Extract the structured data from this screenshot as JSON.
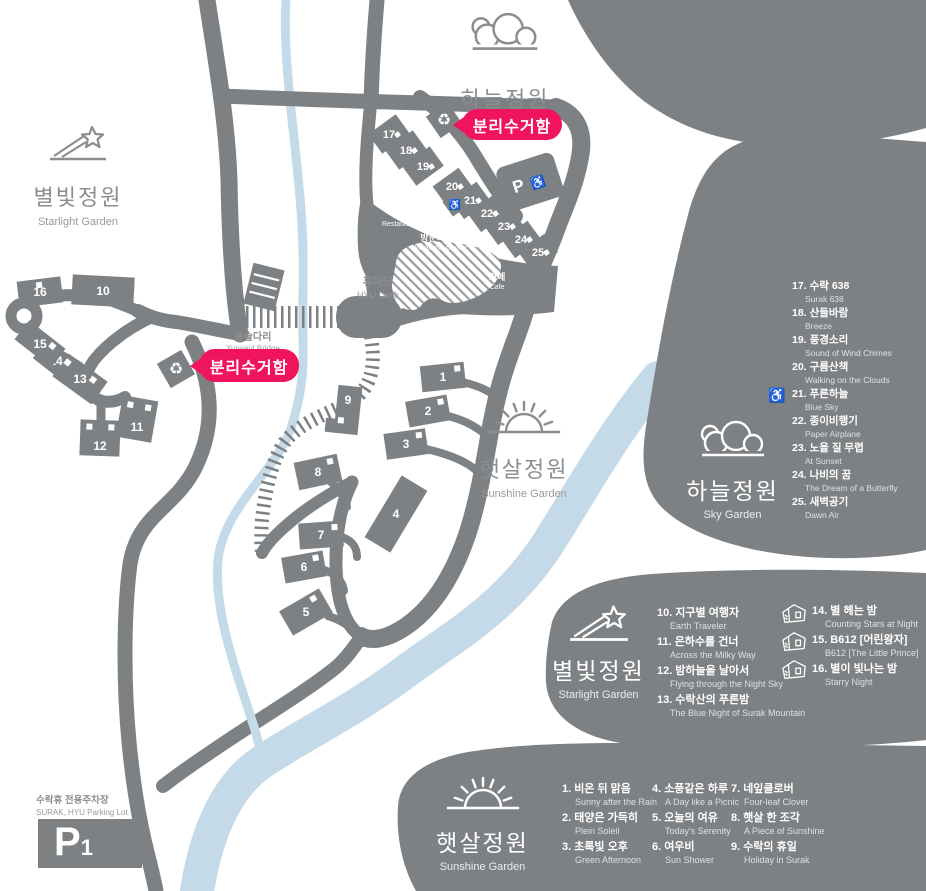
{
  "colors": {
    "gray": "#7e8184",
    "river": "#c5dae8",
    "accent_pink": "#f0145c"
  },
  "icons": {
    "wheelchair": "♿",
    "recycle": "♻"
  },
  "badges": {
    "recycling": "분리수거함"
  },
  "map": {
    "gardens": {
      "sky": {
        "ko": "하늘정원"
      },
      "starlight": {
        "ko": "별빛정원",
        "en": "Starlight Garden"
      },
      "sunshine": {
        "ko": "햇살정원",
        "en": "Sunshine Garden"
      }
    },
    "facilities": {
      "restaurant": {
        "ko": "식당",
        "en": "Restaurant"
      },
      "welcome_center": {
        "ko": "방문자센터",
        "en": "Welcome Center"
      },
      "hyu_deck": {
        "ko": "휴마당",
        "en": "HYU Deck"
      },
      "cafe": {
        "ko": "카페",
        "en": "Cafe"
      },
      "bridge": {
        "ko": "윤슬다리",
        "en": "Yunseul Bridge"
      },
      "parking": {
        "ko": "수락휴 전용주차장",
        "en": "SURAK, HYU Parking Lot",
        "code": "P1"
      },
      "accessible_parking": {
        "label": "P"
      }
    },
    "site_numbers": [
      "1",
      "2",
      "3",
      "4",
      "5",
      "6",
      "7",
      "8",
      "9",
      "10",
      "11",
      "12",
      "13",
      "14",
      "15",
      "16",
      "17",
      "18",
      "19",
      "20",
      "21",
      "22",
      "23",
      "24",
      "25"
    ]
  },
  "legends": {
    "sky": {
      "title_ko": "하늘정원",
      "title_en": "Sky Garden",
      "items": [
        {
          "num": "17.",
          "ko": "수락 638",
          "en": "Surak 638"
        },
        {
          "num": "18.",
          "ko": "산들바람",
          "en": "Breeze"
        },
        {
          "num": "19.",
          "ko": "풍경소리",
          "en": "Sound of Wind Chimes"
        },
        {
          "num": "20.",
          "ko": "구름산책",
          "en": "Walking on the Clouds"
        },
        {
          "num": "21.",
          "ko": "푸른하늘",
          "en": "Blue Sky"
        },
        {
          "num": "22.",
          "ko": "종이비행기",
          "en": "Paper Airplane"
        },
        {
          "num": "23.",
          "ko": "노을 질 무렵",
          "en": "At Sunset"
        },
        {
          "num": "24.",
          "ko": "나비의 꿈",
          "en": "The Dream of a Butterfly"
        },
        {
          "num": "25.",
          "ko": "새벽공기",
          "en": "Dawn Air"
        }
      ]
    },
    "starlight": {
      "title_ko": "별빛정원",
      "title_en": "Starlight Garden",
      "items": [
        {
          "num": "10.",
          "ko": "지구별 여행자",
          "en": "Earth Traveler"
        },
        {
          "num": "11.",
          "ko": "은하수를 건너",
          "en": "Across the Milky Way"
        },
        {
          "num": "12.",
          "ko": "밤하늘을 날아서",
          "en": "Flying through the Night Sky"
        },
        {
          "num": "13.",
          "ko": "수락산의 푸른밤",
          "en": "The Blue Night of Surak Mountain"
        },
        {
          "num": "14.",
          "ko": "별 헤는 밤",
          "en": "Counting Stars at Night"
        },
        {
          "num": "15.",
          "ko": "B612 [어린왕자]",
          "en": "B612 [The Little Prince]"
        },
        {
          "num": "16.",
          "ko": "별이 빛나는 밤",
          "en": "Starry Night"
        }
      ]
    },
    "sunshine": {
      "title_ko": "햇살정원",
      "title_en": "Sunshine Garden",
      "items": [
        {
          "num": "1.",
          "ko": "비온 뒤 맑음",
          "en": "Sunny after the Rain"
        },
        {
          "num": "2.",
          "ko": "태양은 가득히",
          "en": "Plein Soleil"
        },
        {
          "num": "3.",
          "ko": "초록빛 오후",
          "en": "Green Afternoon"
        },
        {
          "num": "4.",
          "ko": "소풍같은 하루",
          "en": "A Day like a Picnic"
        },
        {
          "num": "5.",
          "ko": "오늘의 여유",
          "en": "Today's Serenity"
        },
        {
          "num": "6.",
          "ko": "여우비",
          "en": "Sun Shower"
        },
        {
          "num": "7.",
          "ko": "네잎클로버",
          "en": "Four-leaf Clover"
        },
        {
          "num": "8.",
          "ko": "햇살 한 조각",
          "en": "A Piece of Sunshine"
        },
        {
          "num": "9.",
          "ko": "수락의 휴일",
          "en": "Holiday in Surak"
        }
      ]
    }
  }
}
